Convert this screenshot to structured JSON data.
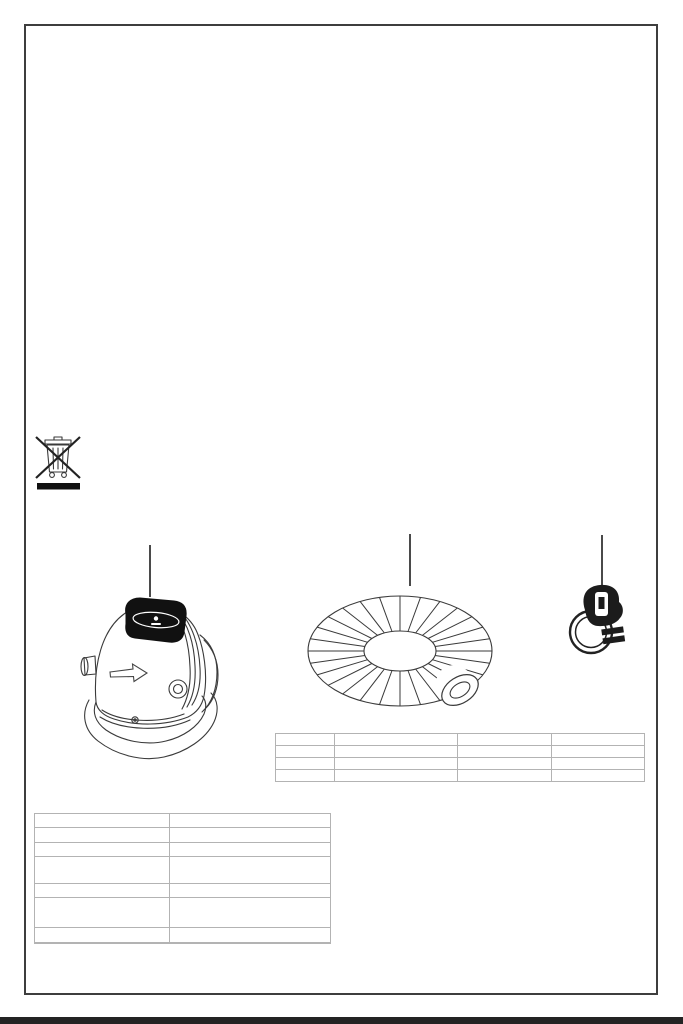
{
  "page": {
    "background_color": "#ffffff",
    "border_color": "#3e3e3e",
    "table_border_color": "#b3b3b3",
    "bottom_bar_color": "#232323",
    "illustration_line_color": "#3a3a3a"
  },
  "symbols": {
    "weee_icon": "crossed-out-wheelie-bin-with-black-bar"
  },
  "figures": {
    "pump": {
      "icon": "air-pump-illustration"
    },
    "hose": {
      "icon": "corrugated-hose-coil-illustration"
    },
    "clamp": {
      "icon": "hose-clamp-illustration"
    }
  },
  "parts_table": {
    "rows": [
      [
        "",
        "",
        "",
        ""
      ],
      [
        "",
        "",
        "",
        ""
      ],
      [
        "",
        "",
        "",
        ""
      ],
      [
        "",
        "",
        "",
        ""
      ]
    ]
  },
  "spec_table": {
    "rows": [
      [
        "",
        ""
      ],
      [
        "",
        ""
      ],
      [
        "",
        ""
      ],
      [
        "",
        ""
      ],
      [
        "",
        ""
      ],
      [
        "",
        ""
      ],
      [
        "",
        ""
      ],
      [
        "",
        ""
      ]
    ]
  }
}
